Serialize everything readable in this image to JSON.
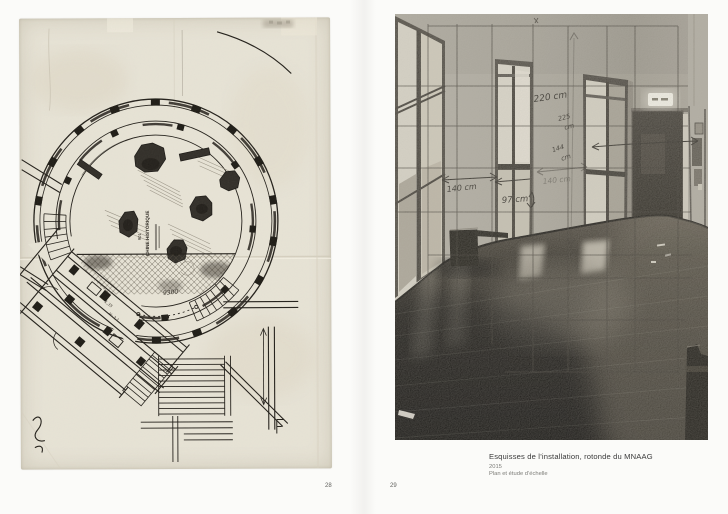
{
  "book": {
    "left_page": {
      "page_number": "28"
    },
    "right_page": {
      "page_number": "29"
    },
    "caption": {
      "title": "Esquisses de l’installation, rotonde du MNAAG",
      "year": "2015",
      "medium": "Plan et étude d’échelle"
    }
  },
  "plan": {
    "center_label": "CHINE HISTORIQUE",
    "room_number": "901",
    "dim_9300": "9300",
    "note_135": "1,35",
    "note_h": "H: 2,1"
  },
  "photo": {
    "annotations": {
      "a220": "220 cm",
      "a225_value": "225",
      "a225_unit": "cm",
      "a144_value": "144",
      "a144_unit": "cm",
      "a140_left": "140 cm",
      "a97": "97 cm",
      "a140_mid": "140 cm"
    }
  },
  "colors": {
    "paper": "#e9e5d8",
    "ink": "#1b1813",
    "photo_wall": "#aaa69b",
    "floor_dark": "#17140f",
    "caption_text": "#3a3a3a"
  }
}
